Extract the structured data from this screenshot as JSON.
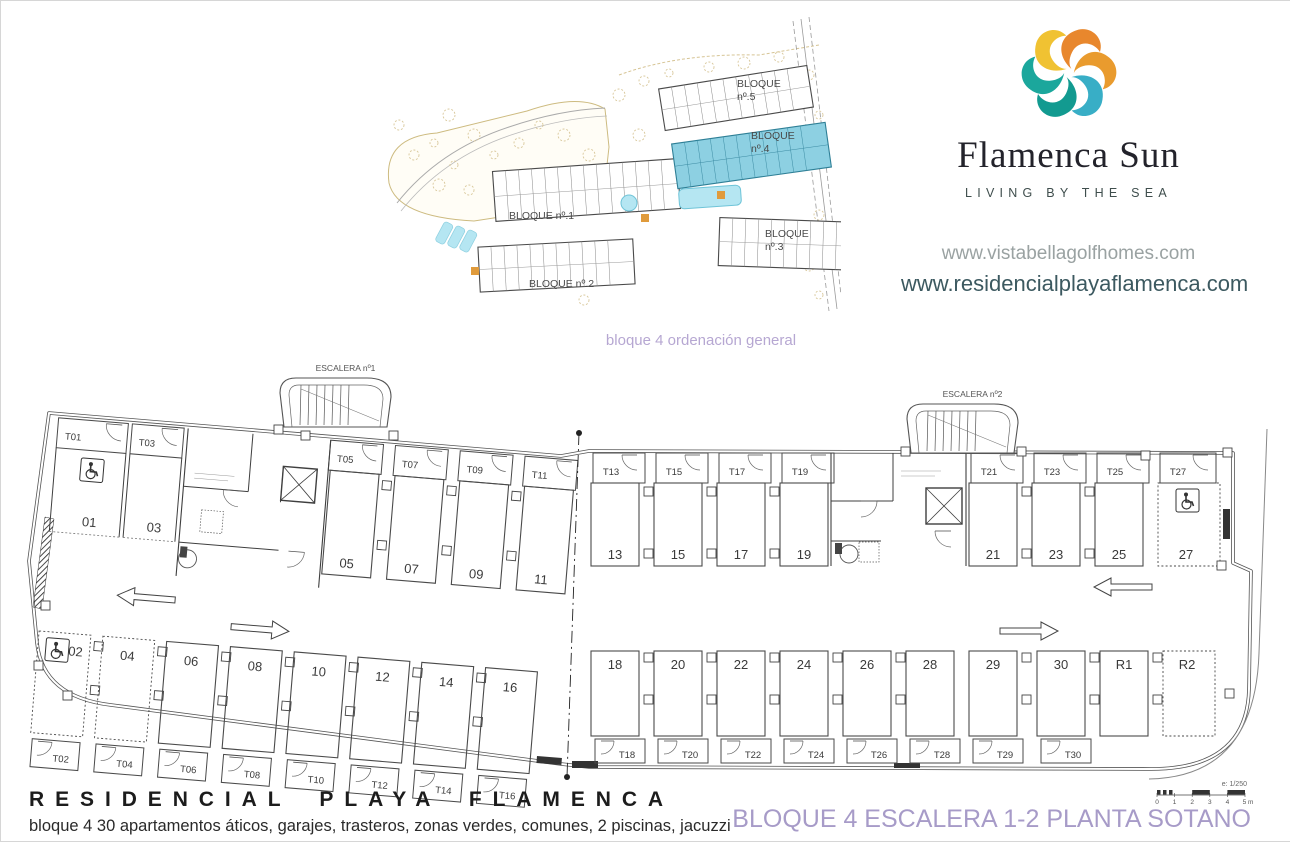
{
  "brand": {
    "name": "Flamenca Sun",
    "tagline": "LIVING BY THE SEA",
    "url_primary": "www.vistabellagolfhomes.com",
    "url_secondary": "www.residencialplayaflamenca.com",
    "logo_colors": [
      "#f0c232",
      "#e8872d",
      "#e99b2e",
      "#38aec6",
      "#129a90",
      "#1ba79c"
    ]
  },
  "site_plan": {
    "caption": "bloque 4 ordenación general",
    "highlight_color": "#8dd0e2",
    "blocks": [
      {
        "id": "bloque-1",
        "label_lines": [
          "BLOQUE nº.1"
        ]
      },
      {
        "id": "bloque-2",
        "label_lines": [
          "BLOQUE nº.2"
        ]
      },
      {
        "id": "bloque-3",
        "label_lines": [
          "BLOQUE",
          "nº.3"
        ]
      },
      {
        "id": "bloque-4",
        "label_lines": [
          "BLOQUE",
          "nº.4"
        ],
        "highlighted": true
      },
      {
        "id": "bloque-5",
        "label_lines": [
          "BLOQUE",
          "nº.5"
        ]
      }
    ]
  },
  "floor_plan": {
    "stair1_label": "ESCALERA nº1",
    "stair2_label": "ESCALERA nº2",
    "left_wing": {
      "top": [
        {
          "spot": "01",
          "trastero": "T01",
          "accessible": true
        },
        {
          "spot": "03",
          "trastero": "T03"
        },
        {
          "spot": "05",
          "trastero": "T05"
        },
        {
          "spot": "07",
          "trastero": "T07"
        },
        {
          "spot": "09",
          "trastero": "T09"
        },
        {
          "spot": "11",
          "trastero": "T11"
        }
      ],
      "bottom": [
        {
          "spot": "02",
          "trastero": "T02",
          "dashed": true,
          "accessible": true
        },
        {
          "spot": "04",
          "trastero": "T04",
          "dashed": true
        },
        {
          "spot": "06",
          "trastero": "T06"
        },
        {
          "spot": "08",
          "trastero": "T08"
        },
        {
          "spot": "10",
          "trastero": "T10"
        },
        {
          "spot": "12",
          "trastero": "T12"
        },
        {
          "spot": "14",
          "trastero": "T14"
        },
        {
          "spot": "16",
          "trastero": "T16"
        }
      ]
    },
    "right_wing": {
      "top": [
        {
          "spot": "13",
          "trastero": "T13"
        },
        {
          "spot": "15",
          "trastero": "T15"
        },
        {
          "spot": "17",
          "trastero": "T17"
        },
        {
          "spot": "19",
          "trastero": "T19"
        },
        {
          "spot": "21",
          "trastero": "T21"
        },
        {
          "spot": "23",
          "trastero": "T23"
        },
        {
          "spot": "25",
          "trastero": "T25"
        },
        {
          "spot": "27",
          "trastero": "T27",
          "dashed": true,
          "accessible": true
        }
      ],
      "bottom": [
        {
          "spot": "18",
          "trastero": "T18"
        },
        {
          "spot": "20",
          "trastero": "T20"
        },
        {
          "spot": "22",
          "trastero": "T22"
        },
        {
          "spot": "24",
          "trastero": "T24"
        },
        {
          "spot": "26",
          "trastero": "T26"
        },
        {
          "spot": "28",
          "trastero": "T28"
        },
        {
          "spot": "29",
          "trastero": "T29"
        },
        {
          "spot": "30",
          "trastero": "T30"
        },
        {
          "spot": "R1"
        },
        {
          "spot": "R2",
          "dashed": true
        }
      ]
    }
  },
  "footer": {
    "title": "RESIDENCIAL PLAYA FLAMENCA",
    "subtitle": "bloque 4 30 apartamentos áticos, garajes, trasteros, zonas verdes, comunes, 2 piscinas, jacuzzi"
  },
  "title_block": {
    "drawing_title": "BLOQUE 4 ESCALERA 1-2 PLANTA SOTANO",
    "scale_note": "e: 1/250",
    "scale_ticks": [
      "0",
      "1",
      "2",
      "3",
      "4",
      "5 m"
    ],
    "title_color": "#a79bc8"
  }
}
